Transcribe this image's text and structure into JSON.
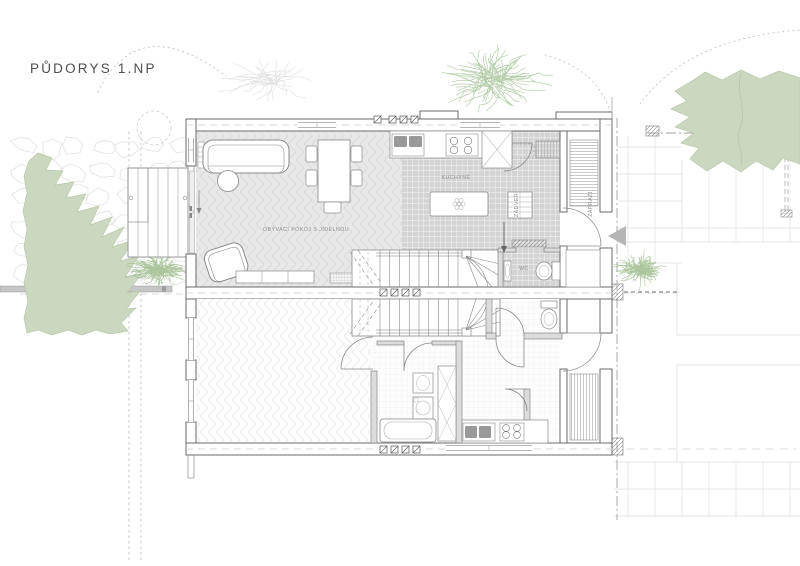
{
  "title": "PŮDORYS 1.NP",
  "rooms": {
    "living": "OBÝVACÍ POKOJ S JÍDELNOU",
    "kitchen": "KUCHYNĚ",
    "hall": "ZÁDVEŘÍ",
    "porch": "ZÁPRAŽÍ",
    "wc": "WC"
  },
  "colors": {
    "canopy": "#ccd7c0",
    "canopy_edge": "#b7c8a6",
    "shrub": "#9cbc8b",
    "tree_sketch": "#a9c79c",
    "faint_sketch": "#dbdbdb",
    "marker": "#b5b5b5",
    "floor_tile": "#d4d4d4",
    "floor_wood": "#e8e8e8",
    "wall_line": "#6a6a6a",
    "furniture_line": "#8a8a8a",
    "site_line": "#9f9f9f"
  }
}
